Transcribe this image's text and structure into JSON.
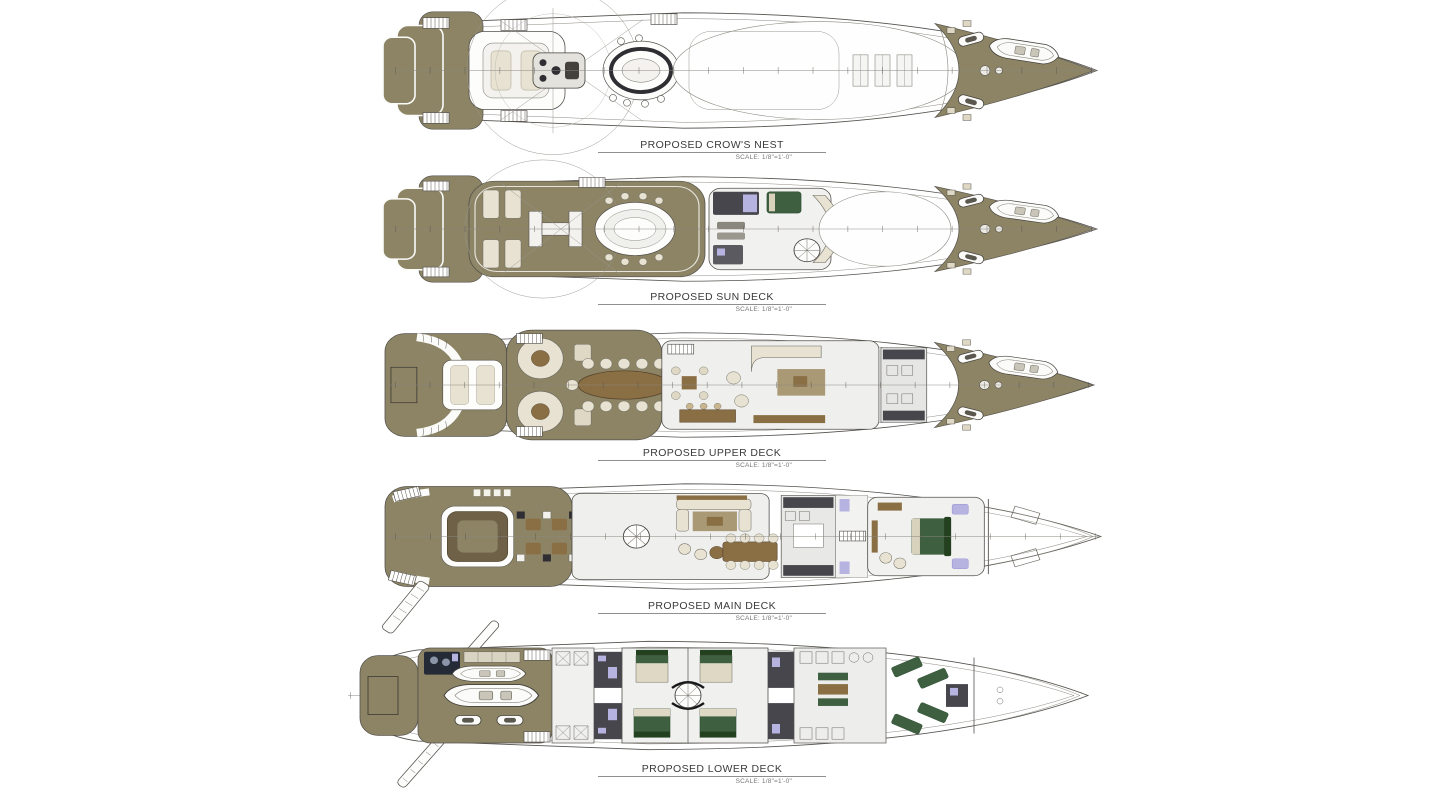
{
  "decks": [
    {
      "id": "crows-nest",
      "label": "PROPOSED CROW'S NEST",
      "scale": "SCALE:  1/8\"=1'-0\""
    },
    {
      "id": "sun-deck",
      "label": "PROPOSED SUN DECK",
      "scale": "SCALE:  1/8\"=1'-0\""
    },
    {
      "id": "upper-deck",
      "label": "PROPOSED UPPER DECK",
      "scale": "SCALE:  1/8\"=1'-0\""
    },
    {
      "id": "main-deck",
      "label": "PROPOSED MAIN DECK",
      "scale": "SCALE:  1/8\"=1'-0\""
    },
    {
      "id": "lower-deck",
      "label": "PROPOSED LOWER DECK",
      "scale": "SCALE:  1/8\"=1'-0\""
    }
  ],
  "colors": {
    "deck_olive": "#8c8465",
    "outline": "#55524d",
    "interior_floor": "#efefed",
    "galley_dark": "#46464c",
    "green_upholstery": "#3f5f41",
    "lavender_fixture": "#b7b3e0",
    "wood": "#8a6f45",
    "cream_seating": "#e7e2d2"
  }
}
